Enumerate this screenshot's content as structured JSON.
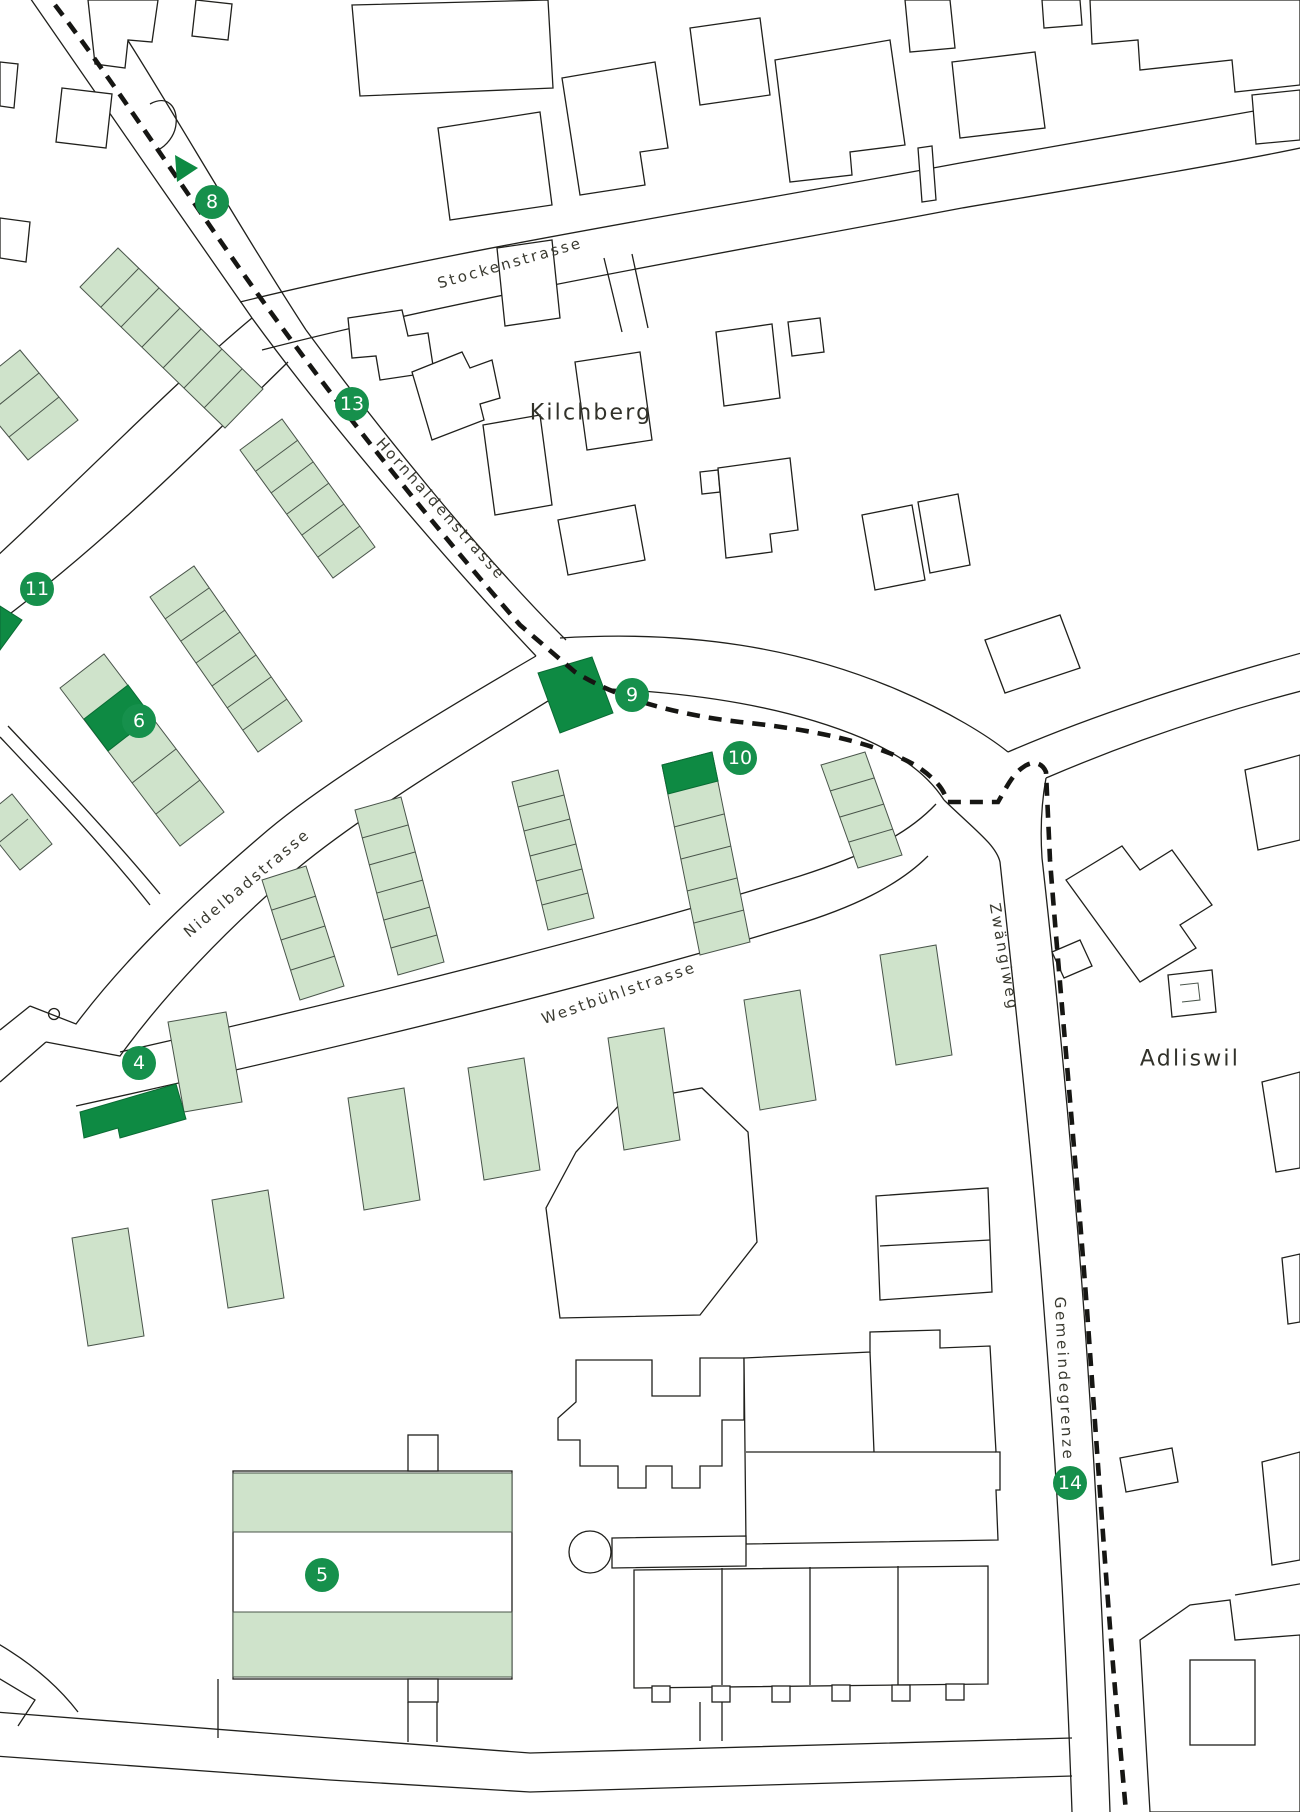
{
  "title": "Site map Kilchberg / Adliswil",
  "colors": {
    "accent_green": "#16904c",
    "highlight_building_green": "#0e8a43",
    "light_building_green": "#cfe3cb",
    "line_black": "#20201c",
    "background": "#ffffff"
  },
  "places": {
    "kilchberg": "Kilchberg",
    "adliswil": "Adliswil"
  },
  "streets": {
    "stockenstrasse": "Stockenstrasse",
    "hornhaldenstrasse": "Hornhaldenstrasse",
    "nidelbadstrasse": "Nidelbadstrasse",
    "westbuehlstrasse": "Westbühlstrasse",
    "zwaengiweg": "Zwängiweg",
    "gemeindegrenze": "Gemeindegrenze"
  },
  "markers": [
    {
      "number": "8"
    },
    {
      "number": "13"
    },
    {
      "number": "11"
    },
    {
      "number": "6"
    },
    {
      "number": "9"
    },
    {
      "number": "10"
    },
    {
      "number": "4"
    },
    {
      "number": "5"
    },
    {
      "number": "14"
    }
  ]
}
